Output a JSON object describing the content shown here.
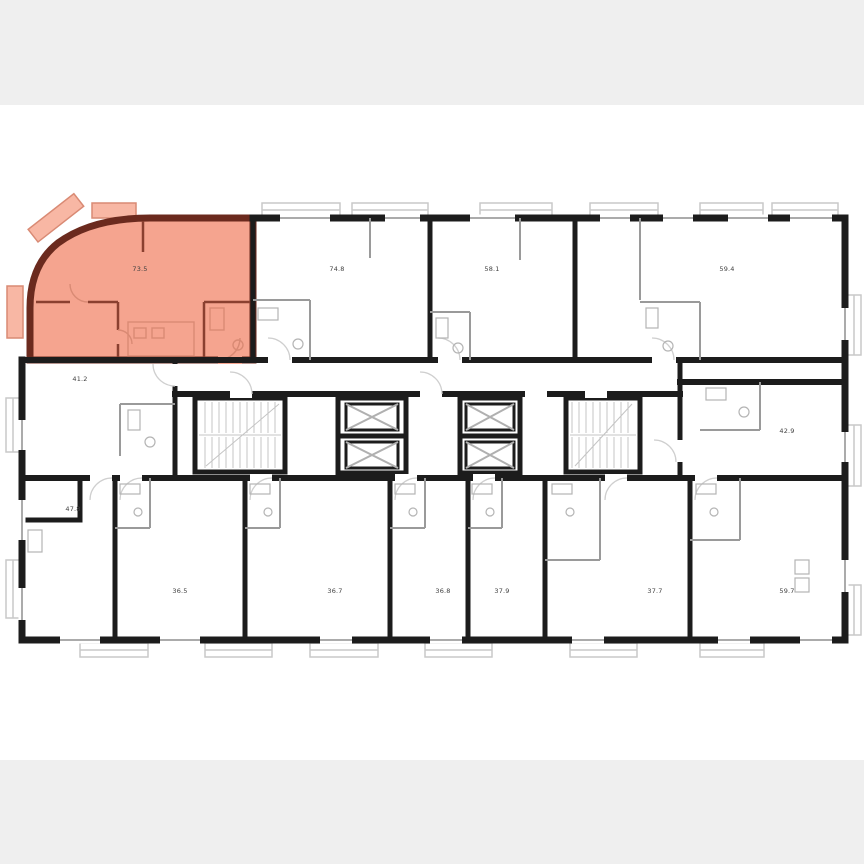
{
  "page": {
    "background_color": "#efefef",
    "canvas_background_color": "#ffffff"
  },
  "plan": {
    "colors": {
      "wall": "#1c1c1c",
      "interior_partition": "#9a9a9a",
      "detail": "#c9c9c9",
      "highlight_fill": "#f5a48f",
      "highlight_wall": "#6b2a1e",
      "highlight_balcony_fill": "#f8b7a4",
      "highlight_balcony_stroke": "#d98a74"
    },
    "units": {
      "u735": {
        "area": "73.5",
        "highlighted": true
      },
      "u748": {
        "area": "74.8"
      },
      "u581": {
        "area": "58.1"
      },
      "u594": {
        "area": "59.4"
      },
      "u412": {
        "area": "41.2"
      },
      "u429": {
        "area": "42.9"
      },
      "u478": {
        "area": "47.8"
      },
      "u365": {
        "area": "36.5"
      },
      "u367": {
        "area": "36.7"
      },
      "u368": {
        "area": "36.8"
      },
      "u379": {
        "area": "37.9"
      },
      "u377": {
        "area": "37.7"
      },
      "u597": {
        "area": "59.7"
      }
    }
  }
}
